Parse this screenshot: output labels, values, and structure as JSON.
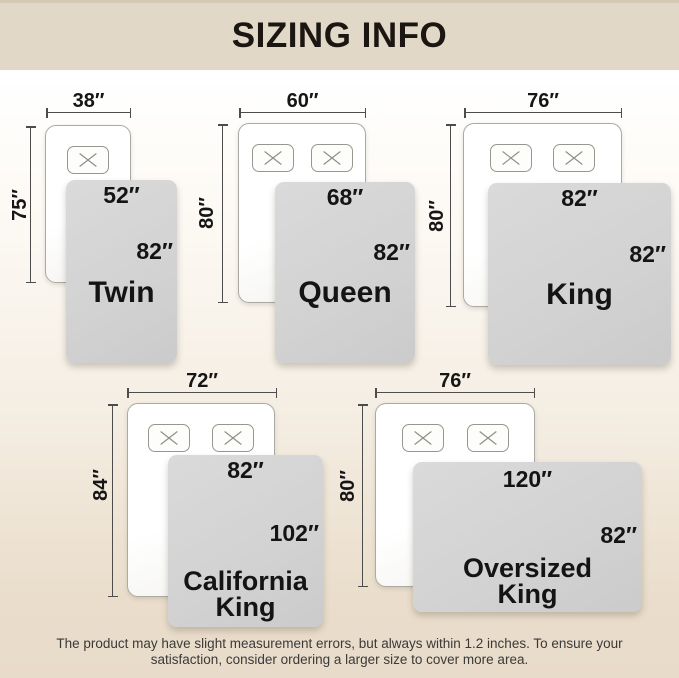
{
  "title": "SIZING INFO",
  "note": {
    "line1": "The product may have slight measurement errors, but always within 1.2 inches. To ensure your",
    "line2": "satisfaction, consider ordering a larger size to cover more area."
  },
  "sizes": [
    {
      "name": "Twin",
      "name_lines": [
        "Twin"
      ],
      "mattress_width": "38″",
      "mattress_length": "75″",
      "blanket_width": "52″",
      "blanket_length": "82″",
      "pillows": 1
    },
    {
      "name": "Queen",
      "name_lines": [
        "Queen"
      ],
      "mattress_width": "60″",
      "mattress_length": "80″",
      "blanket_width": "68″",
      "blanket_length": "82″",
      "pillows": 2
    },
    {
      "name": "King",
      "name_lines": [
        "King"
      ],
      "mattress_width": "76″",
      "mattress_length": "80″",
      "blanket_width": "82″",
      "blanket_length": "82″",
      "pillows": 2
    },
    {
      "name": "California King",
      "name_lines": [
        "California",
        "King"
      ],
      "mattress_width": "72″",
      "mattress_length": "84″",
      "blanket_width": "82″",
      "blanket_length": "102″",
      "pillows": 2
    },
    {
      "name": "Oversized King",
      "name_lines": [
        "Oversized",
        "King"
      ],
      "mattress_width": "76″",
      "mattress_length": "80″",
      "blanket_width": "120″",
      "blanket_length": "82″",
      "pillows": 2
    }
  ],
  "colors": {
    "banner_bg": "#e1d8c7",
    "banner_top_strip": "#d5c9b4",
    "title_text": "#1b1611",
    "background_top": "#ffffff",
    "background_bottom": "#e8dbc9",
    "mattress_fill": "#ffffff",
    "mattress_outline": "#aaa9a4",
    "blanket_fill": "#d2d2d2",
    "dimension_line": "#4c4c4c",
    "label_text": "#141414",
    "note_text": "#3a3a3a"
  }
}
